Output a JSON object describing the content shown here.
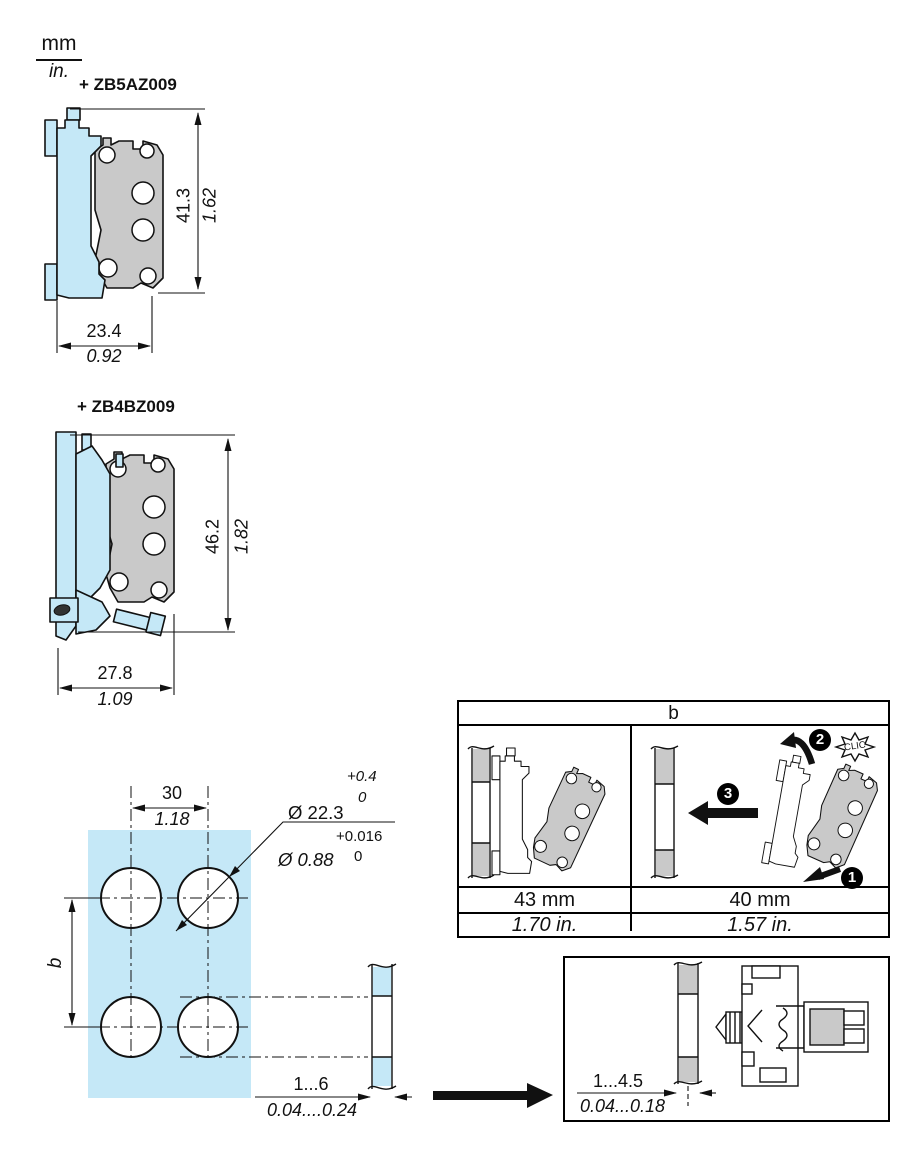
{
  "unit_header": {
    "mm": "mm",
    "in": "in."
  },
  "zb5": {
    "title": "+ ZB5AZ009",
    "h_mm": "41.3",
    "h_in": "1.62",
    "w_mm": "23.4",
    "w_in": "0.92"
  },
  "zb4": {
    "title": "+ ZB4BZ009",
    "h_mm": "46.2",
    "h_in": "1.82",
    "w_mm": "27.8",
    "w_in": "1.09"
  },
  "cutout": {
    "pitch_mm": "30",
    "pitch_in": "1.18",
    "row_pitch_label": "b",
    "dia_mm": "Ø 22.3",
    "dia_mm_tol_up": "+0.4",
    "dia_mm_tol_low": "0",
    "dia_in": "Ø 0.88",
    "dia_in_tol_up": "+0.016",
    "dia_in_tol_low": "0",
    "thick_mm": "1...6",
    "thick_in": "0.04....0.24"
  },
  "clip_table": {
    "header": "b",
    "left": {
      "mm": "43 mm",
      "in": "1.70 in."
    },
    "right": {
      "mm": "40 mm",
      "in": "1.57 in."
    },
    "steps": {
      "one": "1",
      "two": "2",
      "three": "3"
    },
    "clic": "CLIC"
  },
  "mount_box": {
    "thick_mm": "1...4.5",
    "thick_in": "0.04...0.18"
  },
  "colors": {
    "panel_blue": "#c5e8f7",
    "part_gray": "#c9c9c9",
    "line": "#111111"
  }
}
